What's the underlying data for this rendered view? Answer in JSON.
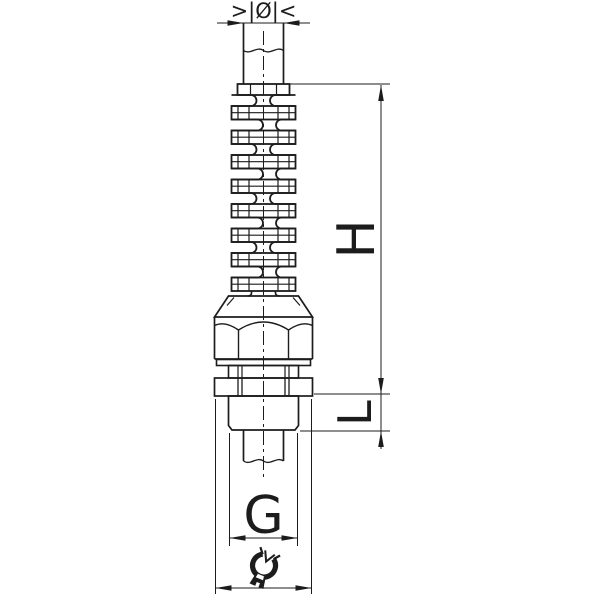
{
  "drawing": {
    "kind": "cable-gland-with-spiral-bend-protection",
    "labels": {
      "diameter": ">|Ø|<",
      "height": "H",
      "length": "L",
      "thread": "G"
    },
    "icons": {
      "wrench": "open-end-wrench-icon"
    },
    "colors": {
      "line": "#1c1c1c",
      "background": "#ffffff"
    }
  }
}
